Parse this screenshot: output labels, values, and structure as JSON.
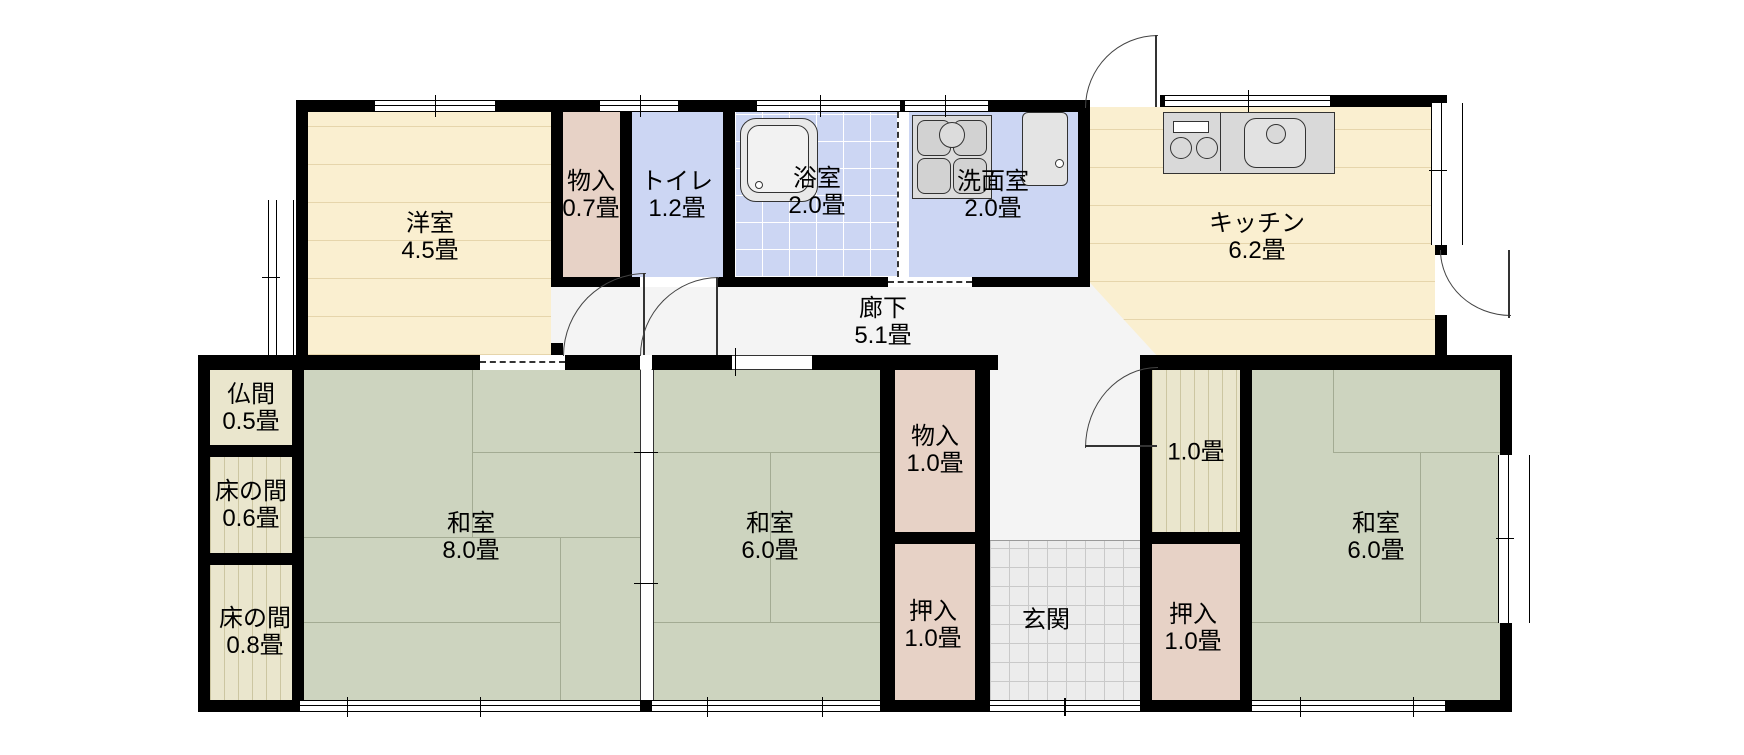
{
  "plan_title": "floor-plan",
  "colors": {
    "wall": "#000000",
    "wood_floor": "#faefd0",
    "tatami_green": "#cdd4bf",
    "closet_pink": "#e7d2c6",
    "wet_room_blue": "#ccd6f3",
    "tokonoma_wood": "#eae6cd",
    "entry_tile_gray": "#ececec",
    "corridor_gray": "#f4f4f4",
    "fixture_gray": "#d9d9d9"
  },
  "rooms": [
    {
      "name": "洋室",
      "size": "4.5畳"
    },
    {
      "name": "物入",
      "size": "0.7畳"
    },
    {
      "name": "トイレ",
      "size": "1.2畳"
    },
    {
      "name": "浴室",
      "size": "2.0畳"
    },
    {
      "name": "洗面室",
      "size": "2.0畳"
    },
    {
      "name": "キッチン",
      "size": "6.2畳"
    },
    {
      "name": "廊下",
      "size": "5.1畳"
    },
    {
      "name": "仏間",
      "size": "0.5畳"
    },
    {
      "name": "床の間",
      "size": "0.6畳"
    },
    {
      "name": "床の間",
      "size": "0.8畳"
    },
    {
      "name": "和室",
      "size": "8.0畳"
    },
    {
      "name": "和室",
      "size": "6.0畳"
    },
    {
      "name": "物入",
      "size": "1.0畳"
    },
    {
      "name": "押入",
      "size": "1.0畳"
    },
    {
      "name": "玄関",
      "size": ""
    },
    {
      "name": "",
      "size": "1.0畳"
    },
    {
      "name": "押入",
      "size": "1.0畳"
    },
    {
      "name": "和室",
      "size": "6.0畳"
    }
  ]
}
